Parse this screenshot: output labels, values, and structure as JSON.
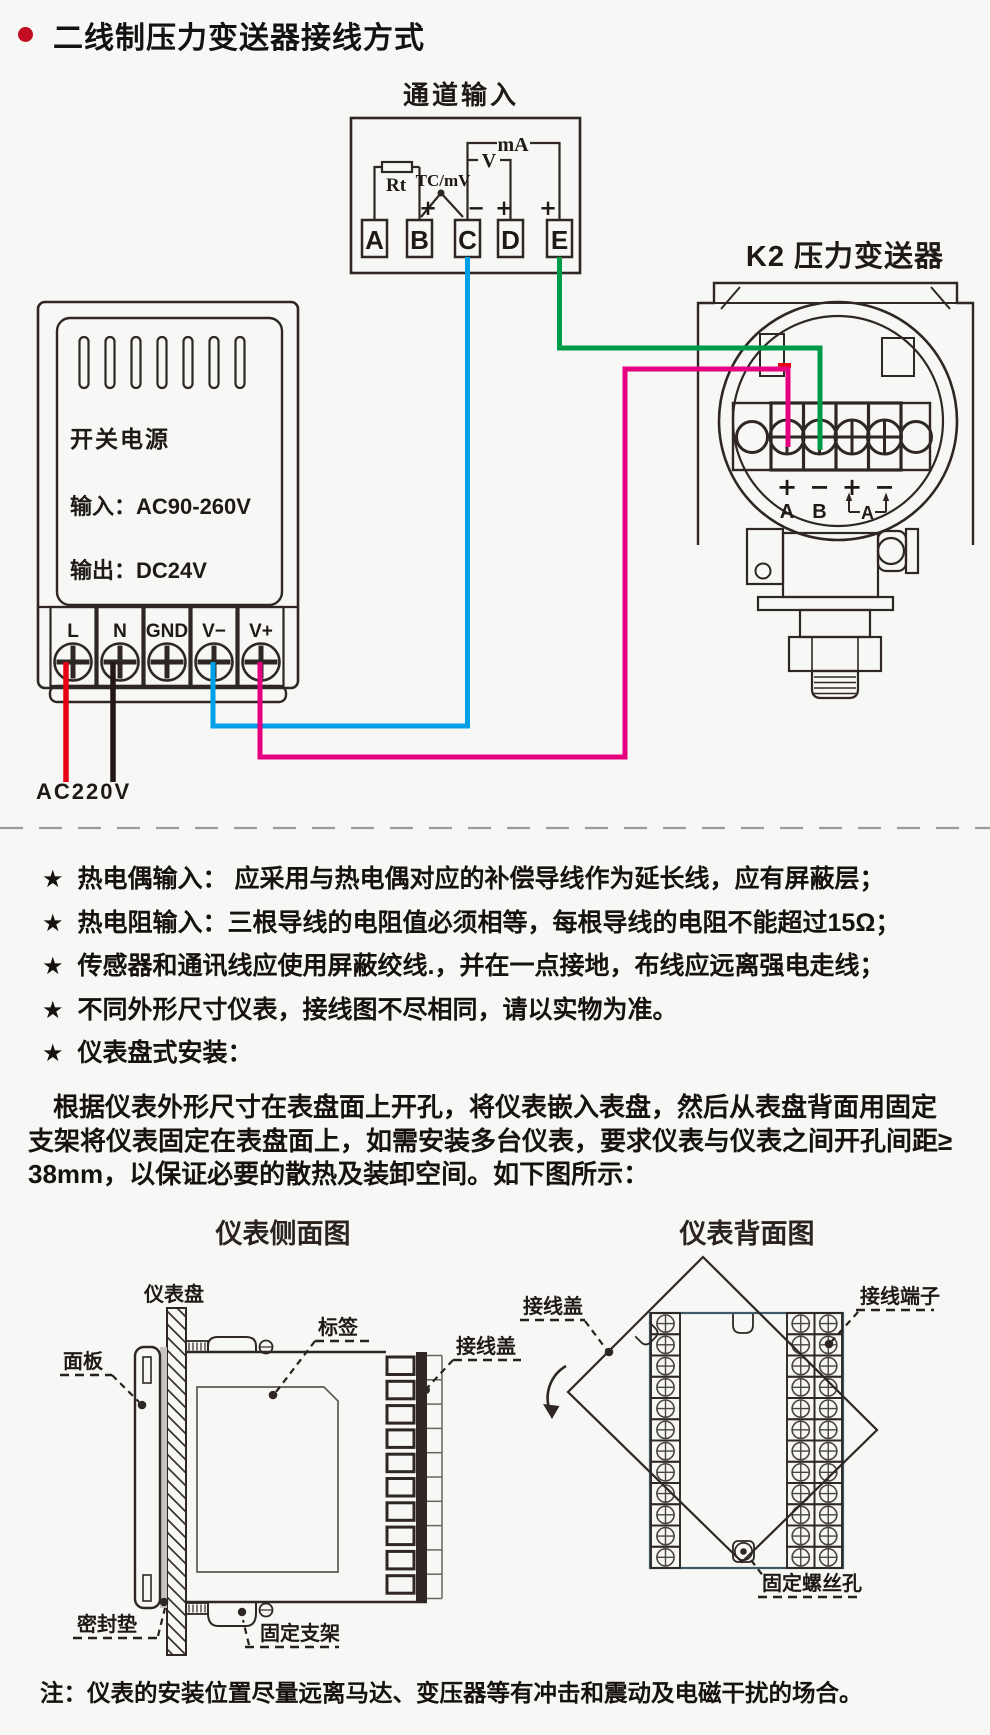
{
  "page": {
    "title": "二线制压力变送器接线方式",
    "bottom_note": "注：仪表的安装位置尽量远离马达、变压器等有冲击和震动及电磁干扰的场合。"
  },
  "channel_input": {
    "title": "通道输入",
    "terminals": [
      "A",
      "B",
      "C",
      "D",
      "E"
    ],
    "rt_label": "Rt",
    "tc_label": "TC/mV",
    "ma_label": "mA",
    "v_label": "V",
    "sign_plus_b": "+",
    "sign_minus_c": "−",
    "sign_plus_d": "+",
    "sign_plus_e": "+"
  },
  "power_supply": {
    "name": "开关电源",
    "input_line": "输入：AC90-260V",
    "output_line": "输出：DC24V",
    "terminals": [
      "L",
      "N",
      "GND",
      "V−",
      "V+"
    ],
    "mains_label": "AC220V"
  },
  "transmitter": {
    "title": "K2 压力变送器",
    "signs": [
      "+",
      "−",
      "+",
      "−"
    ],
    "terminal_a": "A",
    "terminal_b": "B",
    "bracket_label": "A"
  },
  "notes": {
    "star": "★",
    "items": [
      "热电偶输入： 应采用与热电偶对应的补偿导线作为延长线，应有屏蔽层；",
      "热电阻输入：三根导线的电阻值必须相等，每根导线的电阻不能超过15Ω；",
      "传感器和通讯线应使用屏蔽绞线.，并在一点接地，布线应远离强电走线；",
      "不同外形尺寸仪表，接线图不尽相同，请以实物为准。",
      "仪表盘式安装："
    ],
    "paragraph_lines": [
      "根据仪表外形尺寸在表盘面上开孔，将仪表嵌入表盘，然后从表盘背面用固定",
      "支架将仪表固定在表盘面上，如需安装多台仪表，要求仪表与仪表之间开孔间距≥",
      "38mm，以保证必要的散热及装卸空间。如下图所示："
    ]
  },
  "side_view": {
    "title": "仪表侧面图",
    "labels": {
      "panel": "仪表盘",
      "front_panel": "面板",
      "tag": "标签",
      "wiring_cover": "接线盖",
      "gasket": "密封垫",
      "bracket": "固定支架"
    }
  },
  "back_view": {
    "title": "仪表背面图",
    "labels": {
      "wiring_cover": "接线盖",
      "terminal_block": "接线端子",
      "screw_hole": "固定螺丝孔"
    }
  }
}
